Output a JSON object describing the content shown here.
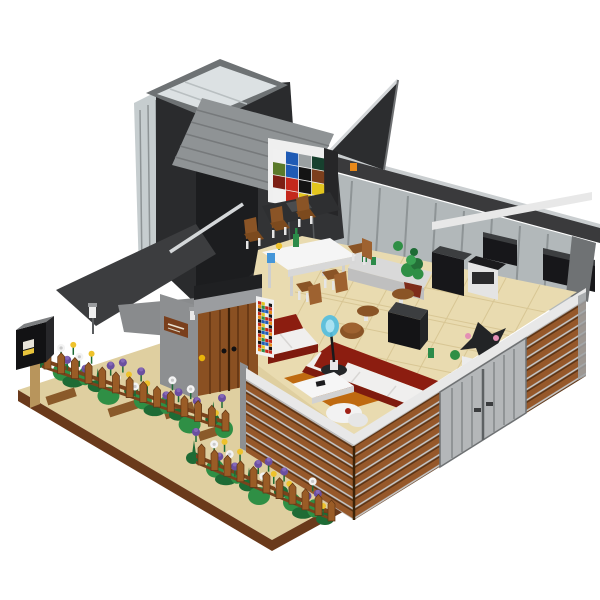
{
  "meta": {
    "type": "product-photo",
    "alt_text": "Isometric LEGO-style modular modern house with cut-away open interior, dark angular roof tower with skylight, Mondrian color panel, dining and living room furniture, wooden slat facade, flower gardens with picket fences, black mailbox on a tan baseplate",
    "background": "#ffffff"
  },
  "palette": {
    "page_bg": "#ffffff",
    "baseplate_tan": "#dfcfa0",
    "baseplate_tan_light": "#e9dbb0",
    "baseplate_edge": "#6a3a1b",
    "path_stone": "#8a5a2a",
    "floor_tan": "#e9dbb0",
    "floor_line": "#d8c694",
    "slat_brown": "#96582a",
    "slat_dark": "#5d3414",
    "slat_light": "#c9c9c9",
    "wall_cap_white": "#e8e8e8",
    "wall_cap_shade": "#b9b9b9",
    "metal_door": "#b4b7b9",
    "metal_door_line": "#85898b",
    "glass": "#c6cdcf",
    "glass_wall": "#b2b8ba",
    "mullion": "#8e9496",
    "roof_gray": "#8f9395",
    "roof_ridge": "#76797b",
    "beam_dark": "#3a3a3c",
    "beam_highlight": "#caced0",
    "tower_dark": "#2a2b2d",
    "tower_black": "#1c1d1f",
    "wing_gray": "#3c3d3f",
    "wing_light": "#898b8d",
    "rail_silver": "#d4d7d9",
    "stone_gray": "#8d8f91",
    "lintel_gray": "#9b9da0",
    "door_brown": "#8a5022",
    "door_plank": "#5f3312",
    "door_knob_yellow": "#e8b40a",
    "sign_brown": "#7a3f1c",
    "fence_brown": "#9a5c26",
    "fence_rail": "#7a431c",
    "fence_line": "#5f3514",
    "foliage_green": "#2f8f45",
    "foliage_dark": "#1e6b35",
    "flower_purple": "#6b4fa0",
    "flower_purple_light": "#8568b8",
    "flower_white": "#f3f3f3",
    "flower_yellow": "#eec22c",
    "mailbox_black": "#121214",
    "mailbox_top": "#7d7f81",
    "mailbox_side": "#27272a",
    "post_tan": "#b8955c",
    "sofa_red": "#8c1d10",
    "sofa_red_dark": "#7e1a0e",
    "cushion_white": "#f0efee",
    "rug_orange": "#bf6a10",
    "table_white": "#f5f5f5",
    "table_shade": "#d8d8d8",
    "chair_brown": "#8a5426",
    "chair_brown_light": "#9e6230",
    "leg_white": "#e5e5e5",
    "lamp_blue": "#54bede",
    "lamp_blue_light": "#a8e2f2",
    "plant_pot": "#7e2c1a",
    "appliance_black": "#17171a",
    "appliance_top": "#3c3e40",
    "counter_white": "#d9d9d9",
    "counter_front": "#bfbfbf",
    "bird_orange": "#e8891a",
    "pink_flower": "#e48fb4",
    "m_white": "#f0f0f0",
    "m_blue": "#1f5bb5",
    "m_red": "#c4281c",
    "m_yellow": "#e3c51e",
    "m_black": "#141414",
    "m_darkgreen": "#17402e",
    "m_olive": "#5a7a2a",
    "m_brown": "#7c3f1d",
    "m_darkred": "#7c1f14",
    "m_tan": "#cbb178",
    "m_gray": "#9aa0a2"
  },
  "mondrian_panel": {
    "rows": [
      [
        "m_white",
        "m_blue",
        "m_gray",
        "m_darkgreen"
      ],
      [
        "m_olive",
        "m_blue",
        "m_black",
        "m_brown"
      ],
      [
        "m_darkred",
        "m_red",
        "m_black",
        "m_yellow"
      ],
      [
        "m_white",
        "m_red",
        "m_yellow",
        "m_tan"
      ]
    ]
  },
  "mosaic_art": {
    "pixel_colors": [
      "m_red",
      "m_blue",
      "m_yellow",
      "bird_orange",
      "m_white",
      "foliage_green",
      "m_black",
      "m_red",
      "m_blue"
    ]
  },
  "gardens": {
    "left_bed": {
      "flower_count": 22,
      "foliage_count": 14,
      "picket_count": 14
    },
    "front_bed": {
      "flower_count": 18,
      "foliage_count": 11,
      "picket_count": 11
    },
    "flower_color_cycle": [
      "flower_purple",
      "flower_white",
      "flower_purple",
      "flower_yellow",
      "flower_white",
      "flower_purple",
      "flower_yellow"
    ]
  },
  "scene": {
    "regions": [
      {
        "name": "roof-tower",
        "description": "dark gray angular tower with transparent skylight and glass side panels"
      },
      {
        "name": "ridged-roof",
        "description": "light gray ridged roof plane sloping down-right"
      },
      {
        "name": "right-roof-wing",
        "description": "dark angled roof wing with silver edge and small orange bird"
      },
      {
        "name": "mondrian-panel",
        "description": "exterior art panel of colored squares"
      },
      {
        "name": "dining-area",
        "description": "white table, six brown chairs, green bottle, yellow flower, blue cup"
      },
      {
        "name": "kitchen",
        "description": "white counters and black appliances along glazed back wall"
      },
      {
        "name": "living-room",
        "description": "two dark-red sofas with white cushions, orange rug, white coffee table, blue floor lamp, brown armchair"
      },
      {
        "name": "entrance",
        "description": "brown double door with yellow knob, gray wall with wooden sign and lamp, colorful mosaic art inside"
      },
      {
        "name": "facade",
        "description": "brown horizontal wood-slat walls with white cap and gray metallic door section"
      },
      {
        "name": "gardens",
        "description": "purple, white and yellow flowers behind brown picket fences"
      },
      {
        "name": "mailbox",
        "description": "black mailbox on tan post at garden corner"
      },
      {
        "name": "baseplate",
        "description": "tan base with dark brown trim and stepping-stone path"
      }
    ]
  }
}
